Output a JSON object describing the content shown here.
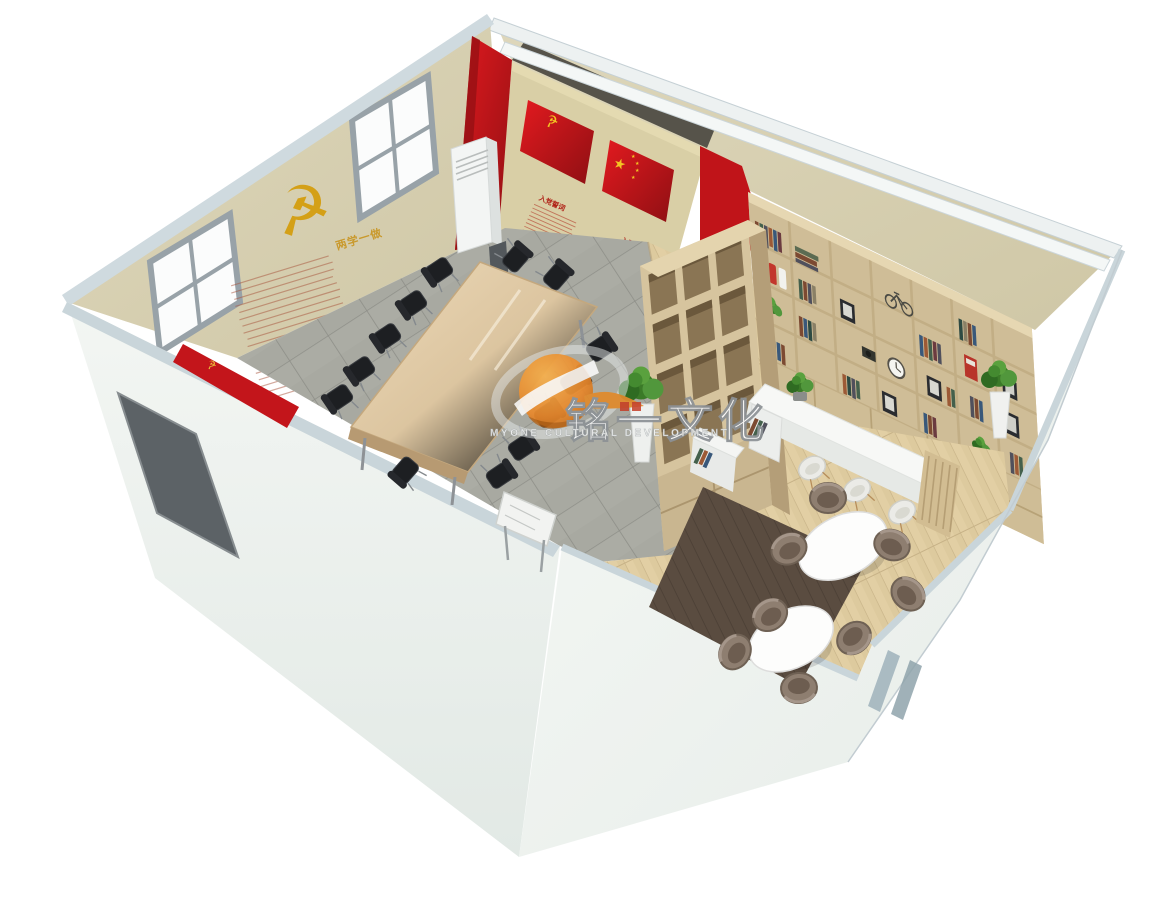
{
  "scene": {
    "description": "3D isometric cutaway rendering of a party-building activity room: meeting area with conference table, flag wall, bookshelf wall and reading lounge",
    "background_color": "#ffffff"
  },
  "watermark": {
    "brand_cn": "铭一文化",
    "brand_en": "MYONE CULTURAL DEVELOPMENT",
    "logo_color": "#e8882c"
  },
  "west_wall": {
    "slogan": "两学一做",
    "emblem_glyph": "☭",
    "emblem_color": "#d4a017"
  },
  "flag_wall": {
    "party_flag": {
      "emblem_glyph": "☭",
      "title": "入党誓词"
    },
    "national_flag": {
      "star_glyph": "★",
      "title": "入团誓词"
    },
    "flag_color": "#c8161d",
    "wall_color": "#d9cfa6"
  },
  "entry_flag_stand": {
    "emblem_glyph": "☭"
  },
  "colors": {
    "exterior_wall": "#eef2f0",
    "wall_rim": "#c9d5da",
    "interior_wall": "#d8d1b4",
    "accent_red": "#c8161d",
    "gold": "#d4a017",
    "wood": "#d7c49e",
    "tile_floor": "#a8a9a1",
    "wood_floor": "#e0cda4",
    "door": "#5c6266",
    "lounge_chair": "#8e7e70",
    "meeting_chair": "#1d1f22"
  }
}
